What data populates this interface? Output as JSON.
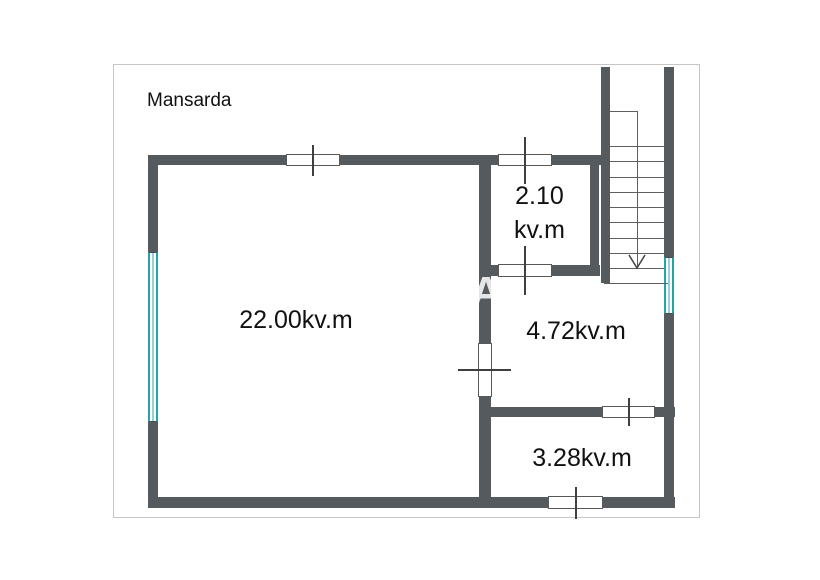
{
  "title": {
    "text": "Mansarda"
  },
  "rooms": {
    "living": {
      "area_label": "22.00kv.m"
    },
    "closet": {
      "area_value": "2.10",
      "area_unit": "kv.m"
    },
    "hall": {
      "area_label": "4.72kv.m"
    },
    "bath": {
      "area_label": "3.28kv.m"
    }
  },
  "stairs": {
    "direction": "down"
  },
  "watermark": {
    "letter": "A"
  },
  "colors": {
    "wall": "#555a5e",
    "window": "#26a3a7",
    "line": "#5f5f5f",
    "tick": "#3f3f3f",
    "text": "#111111",
    "frame": "#c6c6c6"
  }
}
